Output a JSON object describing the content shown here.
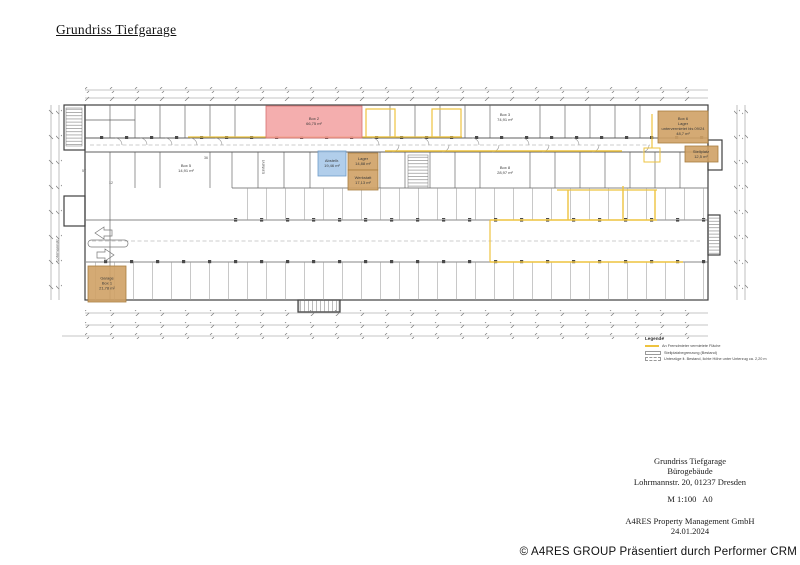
{
  "document": {
    "title": "Grundriss Tiefgarage"
  },
  "plan": {
    "rooms": [
      {
        "id": "box2",
        "label": "Box 2\n66,75 m²",
        "color": "#f2a0a0"
      },
      {
        "id": "abstellraum",
        "label": "Abstellr.\n19,46 m²",
        "color": "#a9c9e9"
      },
      {
        "id": "lager",
        "label": "Lager\n14,88 m²",
        "color": "#cfa165"
      },
      {
        "id": "werkstatt",
        "label": "Werkstatt\n17,13 m²",
        "color": "#cfa165"
      },
      {
        "id": "garage",
        "label": "Garage\nBox 1\n21,78 m²",
        "color": "#cfa165"
      },
      {
        "id": "box6",
        "label": "Box 6\nLager\nuntervermietet bis 09/24\n48,7 m²",
        "color": "#cfa165"
      },
      {
        "id": "stellplatz",
        "label": "Stellplatz\n12,5 m²",
        "color": "#cfa165"
      },
      {
        "id": "box3",
        "label": "Box 3\n74,91 m²"
      },
      {
        "id": "box8",
        "label": "Box 8\n28,97 m²"
      },
      {
        "id": "box5",
        "label": "Box 5\n14,91 m²"
      }
    ],
    "annotations": {
      "street": "Lohrmannstr.",
      "entrance": "Einfahrt",
      "num1": "36",
      "num2": "57",
      "num3": "12"
    }
  },
  "legend": {
    "title": "Legende",
    "items": [
      {
        "label": "An Fremdmieter vermietete Fläche"
      },
      {
        "label": "Stellplatzbegrenzung (Bestand)"
      },
      {
        "label": "Unterzüge lt. Bestand, lichte Höhe unter Unterzug ca. 2,20 m"
      }
    ]
  },
  "title_block": {
    "project": "Grundriss Tiefgarage",
    "building": "Bürogebäude",
    "address": "Lohrmannstr. 20, 01237 Dresden",
    "scale": "M 1:100   A0",
    "company": "A4RES Property Management GmbH",
    "date": "24.01.2024"
  },
  "footer": {
    "watermark": "© A4RES GROUP Präsentiert durch Performer CRM"
  },
  "colors": {
    "highlight_red": "#f2a0a0",
    "highlight_blue": "#a9c9e9",
    "highlight_tan": "#cfa165",
    "highlight_yellow": "#eec33f",
    "line_gray": "#5f5f5f"
  }
}
